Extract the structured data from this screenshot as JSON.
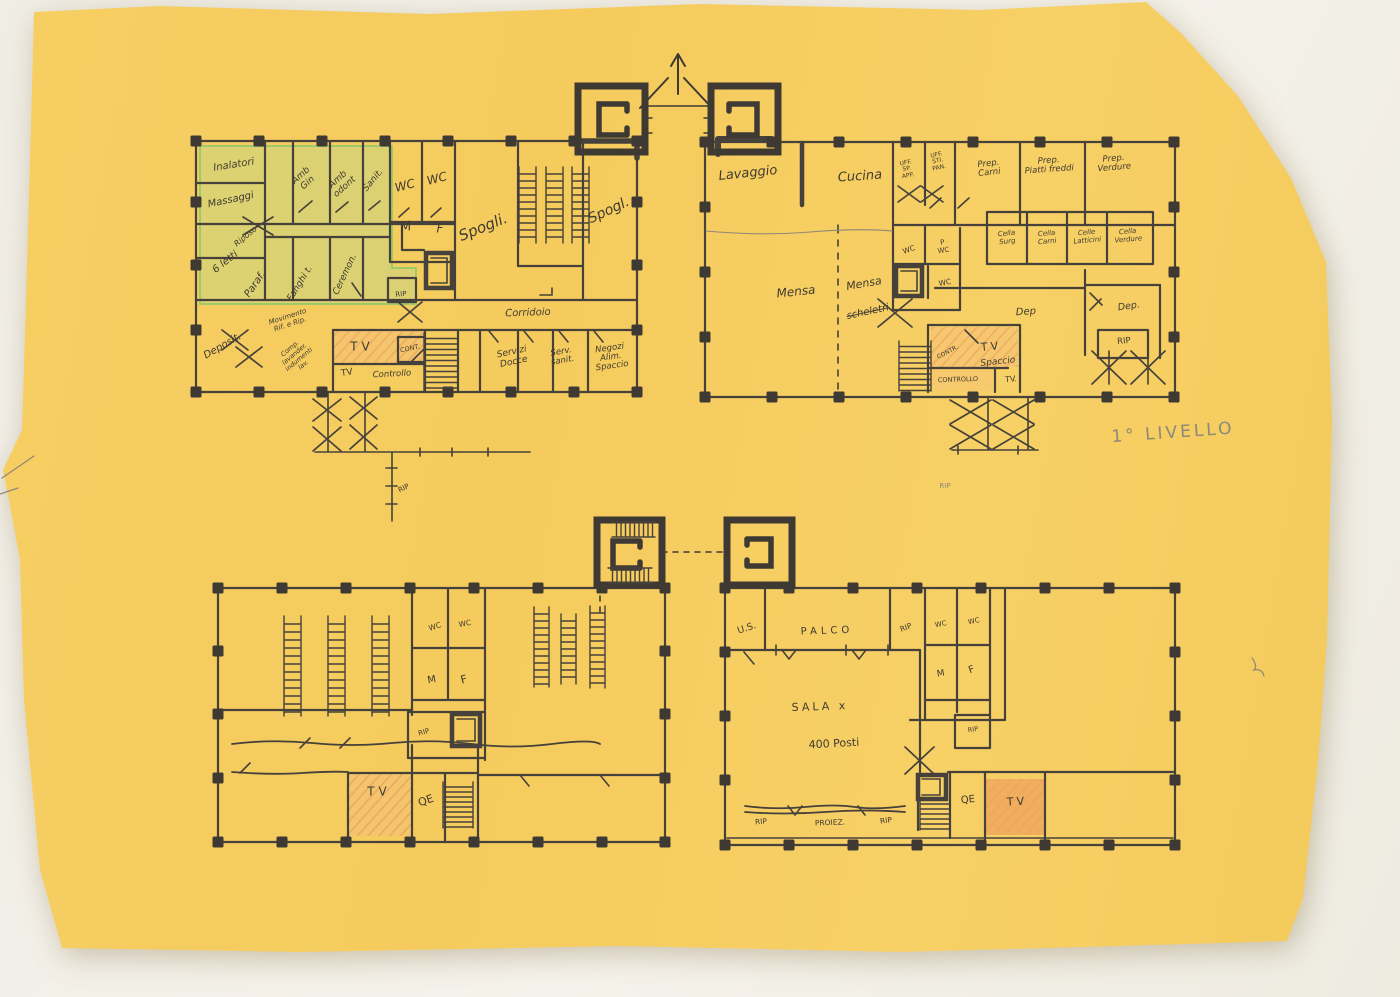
{
  "page": {
    "title_annotation": "1° LIVELLO",
    "language": "Italian"
  },
  "colors": {
    "paper": "#f5cc5f",
    "background": "#f0ede5",
    "ink": "#46413a",
    "pencil": "#8e887a",
    "green_highlight": "#b9d98d",
    "orange_highlight": "#efa55c"
  },
  "labels": [
    {
      "name": "room-inalatori",
      "text": "Inalatori",
      "x": 234,
      "y": 166,
      "rot": -9,
      "size": 10,
      "style": "ink-it"
    },
    {
      "name": "room-massaggi",
      "text": "Massaggi",
      "x": 231,
      "y": 201,
      "rot": -12,
      "size": 10,
      "style": "ink-it"
    },
    {
      "name": "room-amb-gin",
      "text": "Amb\nGin",
      "x": 305,
      "y": 180,
      "rot": -42,
      "size": 9,
      "style": "ink-it"
    },
    {
      "name": "room-amb-odont",
      "text": "Amb\nodont",
      "x": 342,
      "y": 184,
      "rot": -42,
      "size": 9,
      "style": "ink-it"
    },
    {
      "name": "room-sanit",
      "text": "Sanit.",
      "x": 374,
      "y": 181,
      "rot": -50,
      "size": 9,
      "style": "ink-it"
    },
    {
      "name": "room-wc-a1",
      "text": "WC",
      "x": 405,
      "y": 186,
      "rot": -15,
      "size": 12,
      "style": "ink-it"
    },
    {
      "name": "room-wc-a2",
      "text": "WC",
      "x": 437,
      "y": 179,
      "rot": -15,
      "size": 12,
      "style": "ink-it"
    },
    {
      "name": "room-m-a",
      "text": "M",
      "x": 406,
      "y": 228,
      "rot": -10,
      "size": 13,
      "style": "ink-it"
    },
    {
      "name": "room-f-a",
      "text": "F",
      "x": 440,
      "y": 229,
      "rot": 0,
      "size": 12,
      "style": "ink-it"
    },
    {
      "name": "room-spogli-1",
      "text": "Spogli.",
      "x": 483,
      "y": 227,
      "rot": -22,
      "size": 15,
      "style": "ink-it"
    },
    {
      "name": "room-spogli-2",
      "text": "Spogl.",
      "x": 609,
      "y": 211,
      "rot": -25,
      "size": 14,
      "style": "ink-it"
    },
    {
      "name": "room-riposo",
      "text": "Riposo",
      "x": 246,
      "y": 237,
      "rot": -40,
      "size": 8,
      "style": "ink-it"
    },
    {
      "name": "room-6-letti",
      "text": "6 letti",
      "x": 226,
      "y": 263,
      "rot": -38,
      "size": 10,
      "style": "ink-it"
    },
    {
      "name": "room-paraf",
      "text": "Paraf.",
      "x": 256,
      "y": 285,
      "rot": -55,
      "size": 10,
      "style": "ink-it"
    },
    {
      "name": "room-fanghi",
      "text": "Fanghi t.",
      "x": 301,
      "y": 284,
      "rot": -58,
      "size": 9,
      "style": "ink-it"
    },
    {
      "name": "room-ceremon",
      "text": "Ceremon.",
      "x": 346,
      "y": 275,
      "rot": -65,
      "size": 9,
      "style": "ink-it"
    },
    {
      "name": "room-rip-a",
      "text": "RIP",
      "x": 401,
      "y": 295,
      "rot": -5,
      "size": 7,
      "style": "ink"
    },
    {
      "name": "room-deposit",
      "text": "Deposit.",
      "x": 223,
      "y": 347,
      "rot": -30,
      "size": 10,
      "style": "ink-it"
    },
    {
      "name": "note-movimento",
      "text": "Movimento\nRif. e Rip.",
      "x": 289,
      "y": 321,
      "rot": -18,
      "size": 7,
      "style": "ink-it"
    },
    {
      "name": "note-comp-lavander",
      "text": "Comp.\nlavander.\nindumenti\nlav.",
      "x": 297,
      "y": 357,
      "rot": -40,
      "size": 6.5,
      "style": "ink-it"
    },
    {
      "name": "room-tv-a",
      "text": "TV",
      "x": 362,
      "y": 347,
      "rot": 0,
      "size": 12,
      "style": "ink",
      "ls": 4
    },
    {
      "name": "room-cont-a",
      "text": "CONT.",
      "x": 410,
      "y": 349,
      "rot": -12,
      "size": 6.5,
      "style": "ink"
    },
    {
      "name": "room-tv-a2",
      "text": "TV",
      "x": 347,
      "y": 374,
      "rot": -8,
      "size": 9,
      "style": "ink"
    },
    {
      "name": "room-controllo-a",
      "text": "Controllo",
      "x": 392,
      "y": 375,
      "rot": -3,
      "size": 8.5,
      "style": "ink-it"
    },
    {
      "name": "room-corridoio",
      "text": "Corridoio",
      "x": 528,
      "y": 314,
      "rot": -2,
      "size": 10,
      "style": "ink-it"
    },
    {
      "name": "room-servizi-docce",
      "text": "Servizi\nDocce",
      "x": 513,
      "y": 358,
      "rot": -12,
      "size": 9,
      "style": "ink-it"
    },
    {
      "name": "room-serv-sanit",
      "text": "Serv.\nsanit.",
      "x": 562,
      "y": 357,
      "rot": -10,
      "size": 8.5,
      "style": "ink-it"
    },
    {
      "name": "room-negozi",
      "text": "Negozi\nAlim.\nSpaccio",
      "x": 611,
      "y": 358,
      "rot": -8,
      "size": 8.5,
      "style": "ink-it"
    },
    {
      "name": "note-rip-below-a",
      "text": "RIP",
      "x": 404,
      "y": 489,
      "rot": -25,
      "size": 7,
      "style": "ink"
    },
    {
      "name": "room-lavaggio",
      "text": "Lavaggio",
      "x": 748,
      "y": 174,
      "rot": -6,
      "size": 13,
      "style": "ink-it"
    },
    {
      "name": "room-cucina",
      "text": "Cucina",
      "x": 860,
      "y": 177,
      "rot": -4,
      "size": 13,
      "style": "ink-it"
    },
    {
      "name": "room-uff-sp-app",
      "text": "UFF.\nSP.\nAPP.",
      "x": 907,
      "y": 170,
      "rot": -10,
      "size": 6,
      "style": "ink"
    },
    {
      "name": "room-uff-sti-pan",
      "text": "UFF.\nSTI.\nPAN.",
      "x": 938,
      "y": 162,
      "rot": -12,
      "size": 6,
      "style": "ink"
    },
    {
      "name": "room-prep-carni",
      "text": "Prep.\nCarni",
      "x": 989,
      "y": 169,
      "rot": -6,
      "size": 8.5,
      "style": "ink-it"
    },
    {
      "name": "room-prep-piatti-freddi",
      "text": "Prep.\nPiatti freddi",
      "x": 1049,
      "y": 166,
      "rot": -4,
      "size": 8.5,
      "style": "ink-it"
    },
    {
      "name": "room-prep-verdure",
      "text": "Prep.\nVerdure",
      "x": 1114,
      "y": 164,
      "rot": -5,
      "size": 8.5,
      "style": "ink-it"
    },
    {
      "name": "room-cella-surg",
      "text": "Cella\nSurg",
      "x": 1007,
      "y": 238,
      "rot": -6,
      "size": 7,
      "style": "ink-it"
    },
    {
      "name": "room-cella-carni",
      "text": "Cella\nCarni",
      "x": 1047,
      "y": 238,
      "rot": -5,
      "size": 7,
      "style": "ink-it"
    },
    {
      "name": "room-celle-latticini",
      "text": "Celle\nLatticini",
      "x": 1087,
      "y": 237,
      "rot": -5,
      "size": 7,
      "style": "ink-it"
    },
    {
      "name": "room-cella-verdure",
      "text": "Cella\nVerdure",
      "x": 1128,
      "y": 236,
      "rot": -5,
      "size": 7,
      "style": "ink-it"
    },
    {
      "name": "room-mensa-1",
      "text": "Mensa",
      "x": 796,
      "y": 292,
      "rot": -6,
      "size": 12,
      "style": "ink-it"
    },
    {
      "name": "room-mensa-2",
      "text": "Mensa",
      "x": 864,
      "y": 284,
      "rot": -10,
      "size": 11,
      "style": "ink-it"
    },
    {
      "name": "note-scheletri",
      "text": "scheletri",
      "x": 868,
      "y": 313,
      "rot": -12,
      "size": 10,
      "style": "ink-it",
      "crossed": true
    },
    {
      "name": "room-wc-b1",
      "text": "WC",
      "x": 909,
      "y": 250,
      "rot": -20,
      "size": 7.5,
      "style": "ink"
    },
    {
      "name": "room-p-wc-b",
      "text": "P\nWC",
      "x": 943,
      "y": 247,
      "rot": -8,
      "size": 7,
      "style": "ink"
    },
    {
      "name": "room-wc-b2",
      "text": "WC",
      "x": 945,
      "y": 283,
      "rot": -10,
      "size": 7.5,
      "style": "ink"
    },
    {
      "name": "room-dep-b1",
      "text": "Dep",
      "x": 1026,
      "y": 313,
      "rot": -4,
      "size": 10,
      "style": "ink-it"
    },
    {
      "name": "room-dep-b2",
      "text": "Dep.",
      "x": 1129,
      "y": 307,
      "rot": -8,
      "size": 9.5,
      "style": "ink-it"
    },
    {
      "name": "room-rip-b",
      "text": "RIP",
      "x": 1124,
      "y": 342,
      "rot": -5,
      "size": 8.5,
      "style": "ink"
    },
    {
      "name": "room-contr-b",
      "text": "CONTR.",
      "x": 948,
      "y": 353,
      "rot": -28,
      "size": 6,
      "style": "ink"
    },
    {
      "name": "room-tv-b",
      "text": "TV",
      "x": 991,
      "y": 347,
      "rot": -5,
      "size": 11,
      "style": "ink",
      "ls": 3
    },
    {
      "name": "room-spaccio-b",
      "text": "Spaccio",
      "x": 998,
      "y": 363,
      "rot": -6,
      "size": 9,
      "style": "ink-it"
    },
    {
      "name": "room-controllo-b",
      "text": "CONTROLLO",
      "x": 958,
      "y": 380,
      "rot": -2,
      "size": 6.5,
      "style": "ink"
    },
    {
      "name": "room-tv-b2",
      "text": "TV.",
      "x": 1011,
      "y": 380,
      "rot": -5,
      "size": 8,
      "style": "ink"
    },
    {
      "name": "note-rip-stray-b",
      "text": "RIP",
      "x": 945,
      "y": 487,
      "rot": 0,
      "size": 7,
      "style": "pencil"
    },
    {
      "name": "level-title",
      "text": "1° LIVELLO",
      "x": 1173,
      "y": 433,
      "rot": -4,
      "size": 17,
      "style": "pencil",
      "ls": 3
    },
    {
      "name": "room-wc-c1",
      "text": "WC",
      "x": 435,
      "y": 627,
      "rot": -18,
      "size": 7.5,
      "style": "ink"
    },
    {
      "name": "room-wc-c2",
      "text": "WC",
      "x": 465,
      "y": 624,
      "rot": -10,
      "size": 7.5,
      "style": "ink"
    },
    {
      "name": "room-m-c",
      "text": "M",
      "x": 432,
      "y": 681,
      "rot": -10,
      "size": 10,
      "style": "ink"
    },
    {
      "name": "room-f-c",
      "text": "F",
      "x": 464,
      "y": 680,
      "rot": -15,
      "size": 11,
      "style": "ink"
    },
    {
      "name": "room-rip-c",
      "text": "RIP",
      "x": 424,
      "y": 733,
      "rot": -15,
      "size": 7,
      "style": "ink"
    },
    {
      "name": "room-tv-c",
      "text": "TV",
      "x": 379,
      "y": 792,
      "rot": 0,
      "size": 12,
      "style": "ink",
      "ls": 4
    },
    {
      "name": "room-qe-c",
      "text": "QE",
      "x": 426,
      "y": 801,
      "rot": -20,
      "size": 11,
      "style": "ink"
    },
    {
      "name": "room-us-d",
      "text": "U.S.",
      "x": 747,
      "y": 629,
      "rot": -18,
      "size": 9.5,
      "style": "ink"
    },
    {
      "name": "room-palco",
      "text": "PALCO",
      "x": 827,
      "y": 632,
      "rot": -2,
      "size": 10,
      "style": "ink",
      "ls": 4
    },
    {
      "name": "room-rip-d1",
      "text": "RIP",
      "x": 906,
      "y": 628,
      "rot": -22,
      "size": 7.5,
      "style": "ink"
    },
    {
      "name": "room-wc-d1",
      "text": "WC",
      "x": 941,
      "y": 625,
      "rot": -12,
      "size": 7,
      "style": "ink"
    },
    {
      "name": "room-wc-d2",
      "text": "WC",
      "x": 974,
      "y": 622,
      "rot": -12,
      "size": 7,
      "style": "ink"
    },
    {
      "name": "room-m-d",
      "text": "M",
      "x": 941,
      "y": 675,
      "rot": -10,
      "size": 9,
      "style": "ink"
    },
    {
      "name": "room-f-d",
      "text": "F",
      "x": 972,
      "y": 671,
      "rot": -20,
      "size": 10,
      "style": "ink"
    },
    {
      "name": "room-sala",
      "text": "SALA x",
      "x": 820,
      "y": 707,
      "rot": -2,
      "size": 11,
      "style": "ink",
      "ls": 3
    },
    {
      "name": "room-sala-posti",
      "text": "400 Posti",
      "x": 834,
      "y": 744,
      "rot": -3,
      "size": 11,
      "style": "ink"
    },
    {
      "name": "room-rip-d2",
      "text": "RIP",
      "x": 973,
      "y": 730,
      "rot": -8,
      "size": 6.5,
      "style": "ink"
    },
    {
      "name": "room-rip-d3",
      "text": "RIP",
      "x": 761,
      "y": 822,
      "rot": -5,
      "size": 7.5,
      "style": "ink"
    },
    {
      "name": "room-proiez",
      "text": "PROIEZ.",
      "x": 830,
      "y": 823,
      "rot": -2,
      "size": 7.5,
      "style": "ink"
    },
    {
      "name": "room-rip-d4",
      "text": "RIP",
      "x": 886,
      "y": 821,
      "rot": -8,
      "size": 7.5,
      "style": "ink"
    },
    {
      "name": "room-qe-d",
      "text": "QE",
      "x": 968,
      "y": 801,
      "rot": -5,
      "size": 10,
      "style": "ink"
    },
    {
      "name": "room-tv-d",
      "text": "TV",
      "x": 1017,
      "y": 802,
      "rot": -3,
      "size": 11,
      "style": "ink",
      "ls": 3
    }
  ]
}
